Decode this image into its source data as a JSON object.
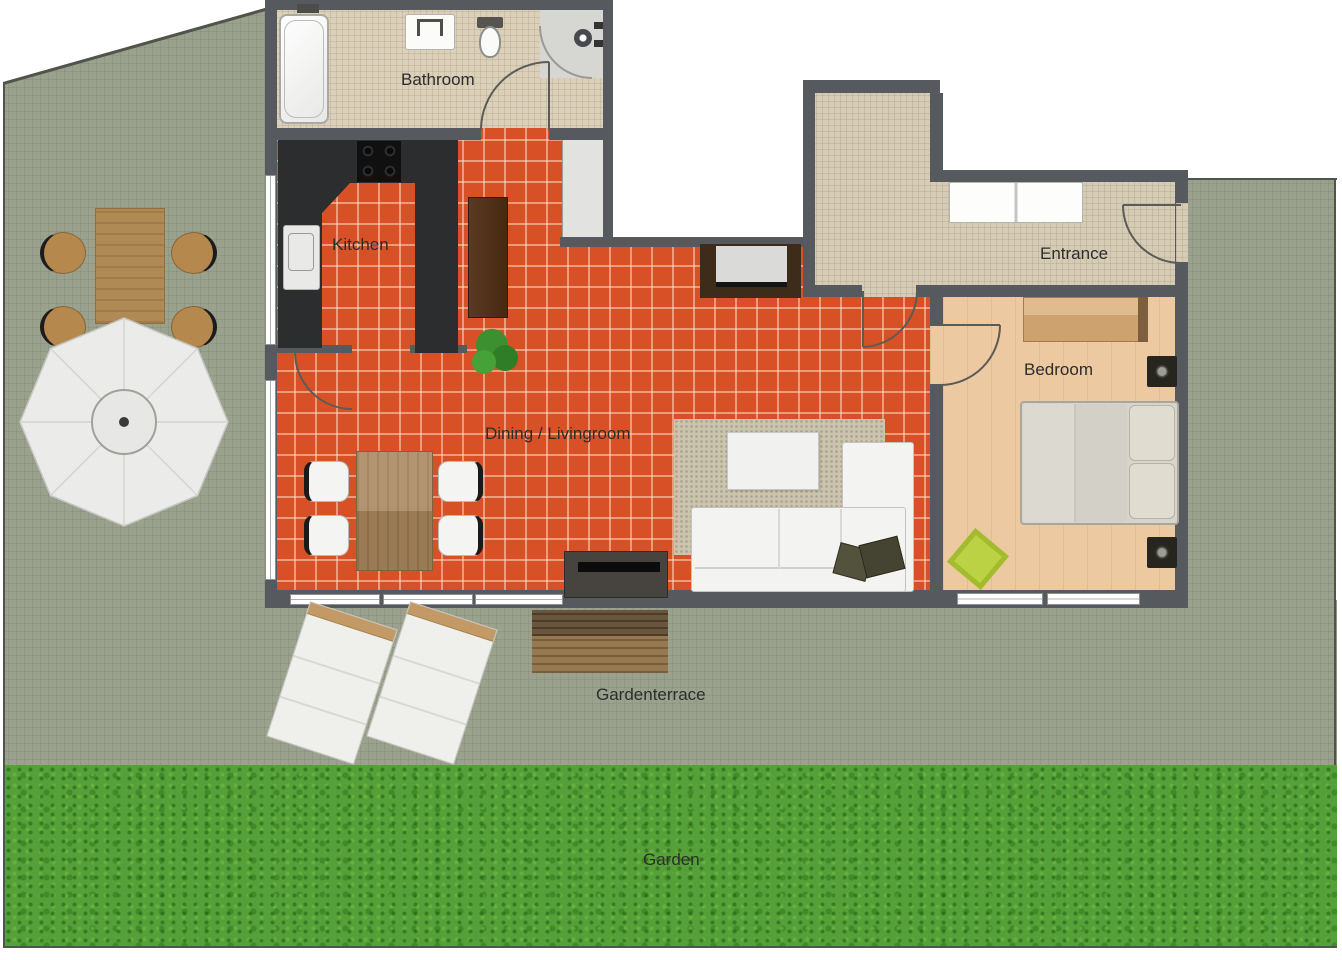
{
  "rooms": {
    "bathroom": {
      "label": "Bathroom"
    },
    "kitchen": {
      "label": "Kitchen"
    },
    "dining_livingroom": {
      "label": "Dining / Livingroom"
    },
    "entrance": {
      "label": "Entrance"
    },
    "bedroom": {
      "label": "Bedroom"
    },
    "gardenterrace": {
      "label": "Gardenterrace"
    },
    "garden": {
      "label": "Garden"
    }
  },
  "colors": {
    "tile_orange": "#D85126",
    "wall_gray": "#56595D",
    "terrace_gray_green": "#9AA28E",
    "grass_green": "#55A038",
    "bathroom_beige": "#DBD1BA",
    "entrance_beige": "#D6CCB6",
    "bedroom_wood": "#ECC9A1",
    "counter_dark": "#2C2D2F",
    "label_text": "#2D2D2D"
  }
}
